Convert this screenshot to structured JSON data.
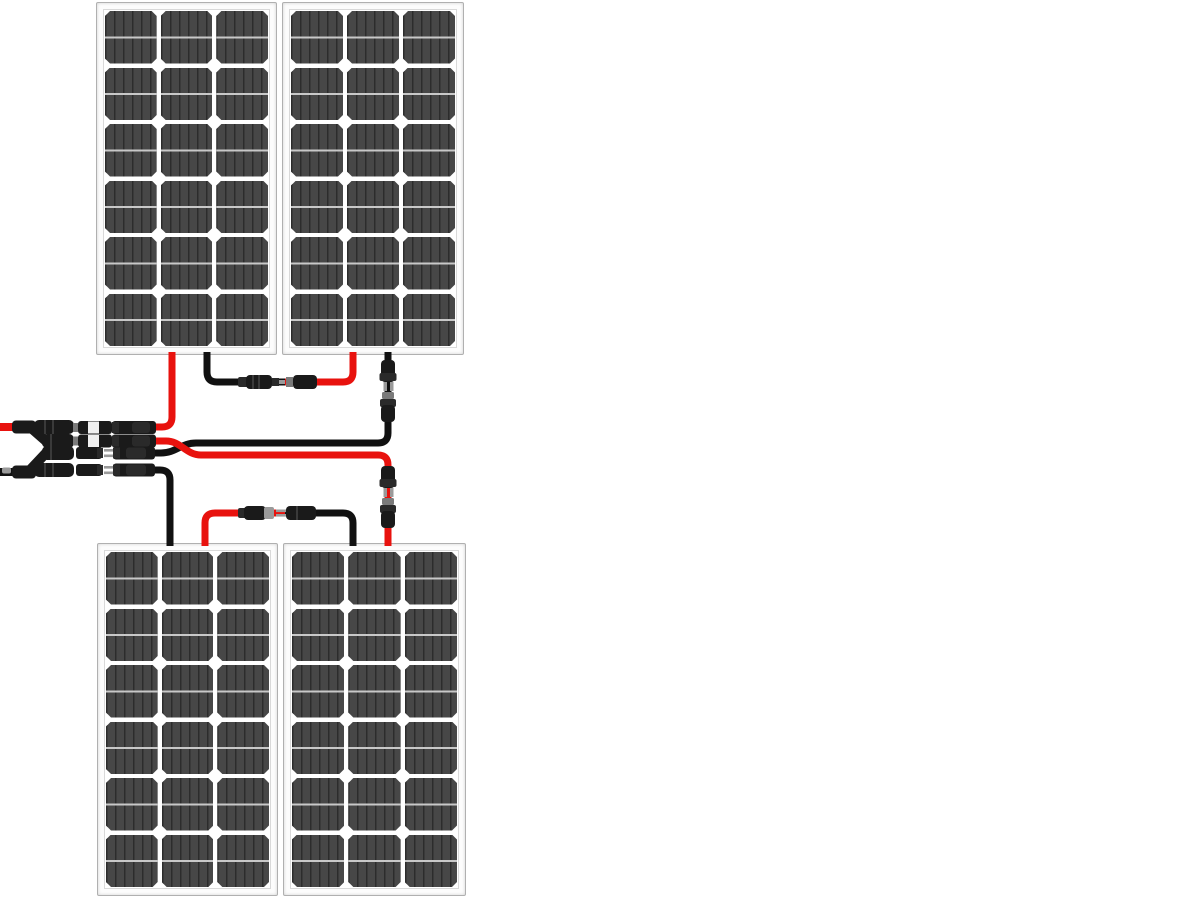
{
  "colors": {
    "background": "#ffffff",
    "panel-frame": "#fcfcfc",
    "panel-border": "#b0b0b0",
    "panel-inner-line": "#d9d9d9",
    "cell-fill": "#474747",
    "cell-stripe": "#2c2c2c",
    "cell-gridline": "#c8c8c8",
    "positive-wire": "#e8120e",
    "negative-wire": "#111111",
    "connector-body": "#1a1a1a",
    "connector-dark": "#2a2a2a",
    "connector-metal": "#9a9a9a",
    "connector-collar": "#7a7a7a",
    "connector-label": "#f0f0f0"
  },
  "panels": {
    "count": 4,
    "cell_rows": 6,
    "cell_columns": 3,
    "items": [
      {
        "id": "top-left"
      },
      {
        "id": "top-right"
      },
      {
        "id": "bottom-left"
      },
      {
        "id": "bottom-right"
      }
    ]
  },
  "wiring": {
    "configuration": "series-parallel (2S2P)",
    "connections": [
      {
        "from": "top-left-panel-negative",
        "to": "top-right-panel-positive",
        "via": "mc4-connector-pair"
      },
      {
        "from": "bottom-left-panel-positive",
        "to": "bottom-right-panel-negative",
        "via": "mc4-connector-pair"
      },
      {
        "from": "top-left-panel-positive",
        "to": "y-branch-positive",
        "via": "mc4-connector-pair"
      },
      {
        "from": "bottom-right-panel-positive",
        "to": "y-branch-positive",
        "via": "mc4-inline-connector"
      },
      {
        "from": "top-right-panel-negative",
        "to": "y-branch-negative",
        "via": "mc4-inline-connector"
      },
      {
        "from": "bottom-left-panel-negative",
        "to": "y-branch-negative",
        "via": "mc4-connector-pair"
      }
    ],
    "outputs": [
      {
        "id": "array-positive-lead",
        "color": "#e8120e"
      },
      {
        "id": "array-negative-lead",
        "color": "#111111"
      }
    ]
  }
}
